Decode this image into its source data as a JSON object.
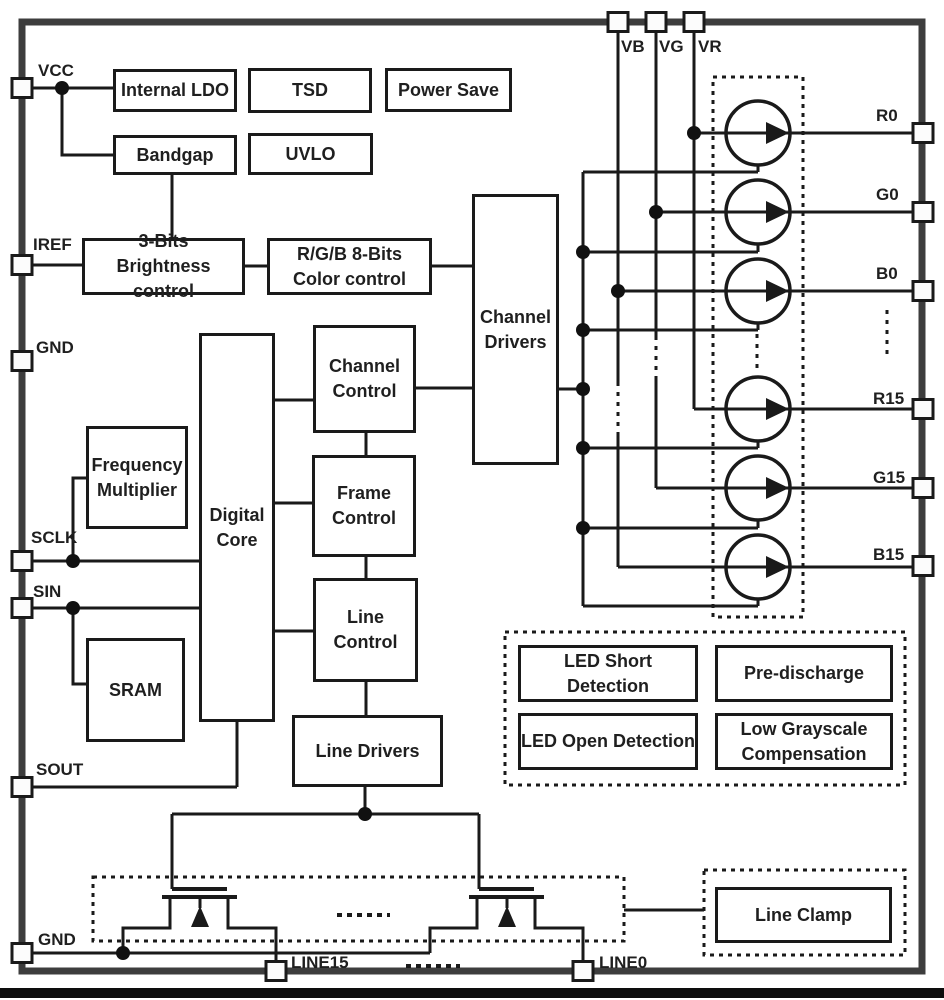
{
  "diagram": {
    "title_hint": "LED driver IC functional block diagram",
    "blocks": {
      "internal_ldo": "Internal LDO",
      "tsd": "TSD",
      "power_save": "Power Save",
      "bandgap": "Bandgap",
      "uvlo": "UVLO",
      "brightness_control": "3-Bits\nBrightness control",
      "color_control": "R/G/B 8-Bits\nColor control",
      "channel_drivers": "Channel\nDrivers",
      "channel_control": "Channel\nControl",
      "frame_control": "Frame\nControl",
      "line_control": "Line\nControl",
      "digital_core": "Digital\nCore",
      "frequency_multiplier": "Frequency\nMultiplier",
      "sram": "SRAM",
      "line_drivers": "Line Drivers",
      "led_short_detection": "LED Short Detection",
      "pre_discharge": "Pre-discharge",
      "led_open_detection": "LED Open Detection",
      "low_grayscale_compensation": "Low Grayscale\nCompensation",
      "line_clamp": "Line Clamp"
    },
    "pins": {
      "vcc": "VCC",
      "iref": "IREF",
      "gnd_upper": "GND",
      "sclk": "SCLK",
      "sin": "SIN",
      "sout": "SOUT",
      "gnd_lower": "GND",
      "vb": "VB",
      "vg": "VG",
      "vr": "VR",
      "r0": "R0",
      "g0": "G0",
      "b0": "B0",
      "r15": "R15",
      "g15": "G15",
      "b15": "B15",
      "line15": "LINE15",
      "line0": "LINE0"
    },
    "colors": {
      "wire": "#1a1a1a",
      "chip_border": "#3d3d3d",
      "background": "#ffffff",
      "text": "#1f1f1f"
    }
  }
}
